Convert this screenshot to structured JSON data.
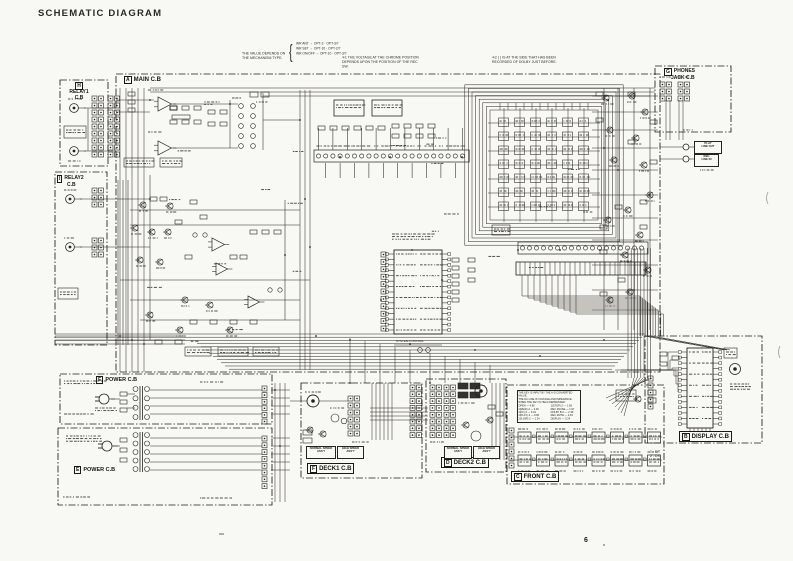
{
  "page": {
    "title": "SCHEMATIC DIAGRAM",
    "page_number": "6"
  },
  "blocks": {
    "main": {
      "tag": "A",
      "label": "MAIN C.B"
    },
    "display": {
      "tag": "B",
      "label": "DISPLAY C.B"
    },
    "front": {
      "tag": "C",
      "label": "FRONT C.B"
    },
    "deck2": {
      "tag": "D",
      "label": "DECK2 C.B"
    },
    "power1": {
      "tag": "E",
      "label": "POWER C.B"
    },
    "power2": {
      "tag": "E",
      "label": "POWER C.B"
    },
    "deck1": {
      "tag": "F",
      "label": "DECK1 C.B"
    },
    "phones": {
      "tag": "G",
      "label": "PHONES",
      "label2": "JACK C.B"
    },
    "relay1": {
      "tag": "H",
      "label": "RELAY1",
      "label2": "C.B"
    },
    "relay2": {
      "tag": "I",
      "label": "RELAY2",
      "label2": "C.B"
    }
  },
  "labels": {
    "play_line_out_1": "PLAY",
    "play_line_out_2": "LINE OUT",
    "rec_line_in_1": "REC",
    "rec_line_in_2": "LINE IN",
    "deck1_normal": "NORMAL SPEED ASS'Y",
    "deck1_high": "HIGH SPEED ASS'Y",
    "deck2_normal": "NORMAL SPEED ASS'Y",
    "deck2_high": "HIGH SPEED ASS'Y",
    "system_control": "SYSTEM CONTROL",
    "display_note_1": "1 - CX",
    "display_note_2": "2 - DX"
  },
  "notes": {
    "note1": "THE VALUE DEPENDS ON THE MECHANISM TYPE.",
    "note2": {
      "rows": [
        "WR ANT → OPT-2 · OPT-3/7",
        "WR SET → OPT-10 · OPT-2/7",
        "WR ON/OFF → OPT-10 · OPT-3/7"
      ]
    },
    "note3": "✳1  THE VOLTAGE AT THE CHROME POSITION DEPENDS UPON THE POSITION OF THE REC SW.",
    "note4": "✳2  ( ) IS AT THE SIDE THAT HAS BEEN RECORDED OF DOLBY JUST BEFORE."
  },
  "front_note": {
    "lines": [
      "THE KEY IS INPUT BY THE A-D CONVERTED VALUE.",
      "THE DC LINE IS VOLTAGE AND IMPEDANCE.",
      "WHEN THE KEY IS HELD DEPRESSED:"
    ],
    "table": [
      "OPEN — 4.96",
      "1(REW)·2 — 0.00",
      "1(FF)·2 — 0.44",
      "1(PLAY)·2 — 0.86",
      "1(S.DIR)·2 — 1.24",
      "1(STOP)·2 — 1.58",
      "REC·PAUSE — 1.97",
      "DOLBY B·C — 2.39",
      "REC MUTE — 2.81",
      "DISPLAY — 3.24"
    ]
  }
}
